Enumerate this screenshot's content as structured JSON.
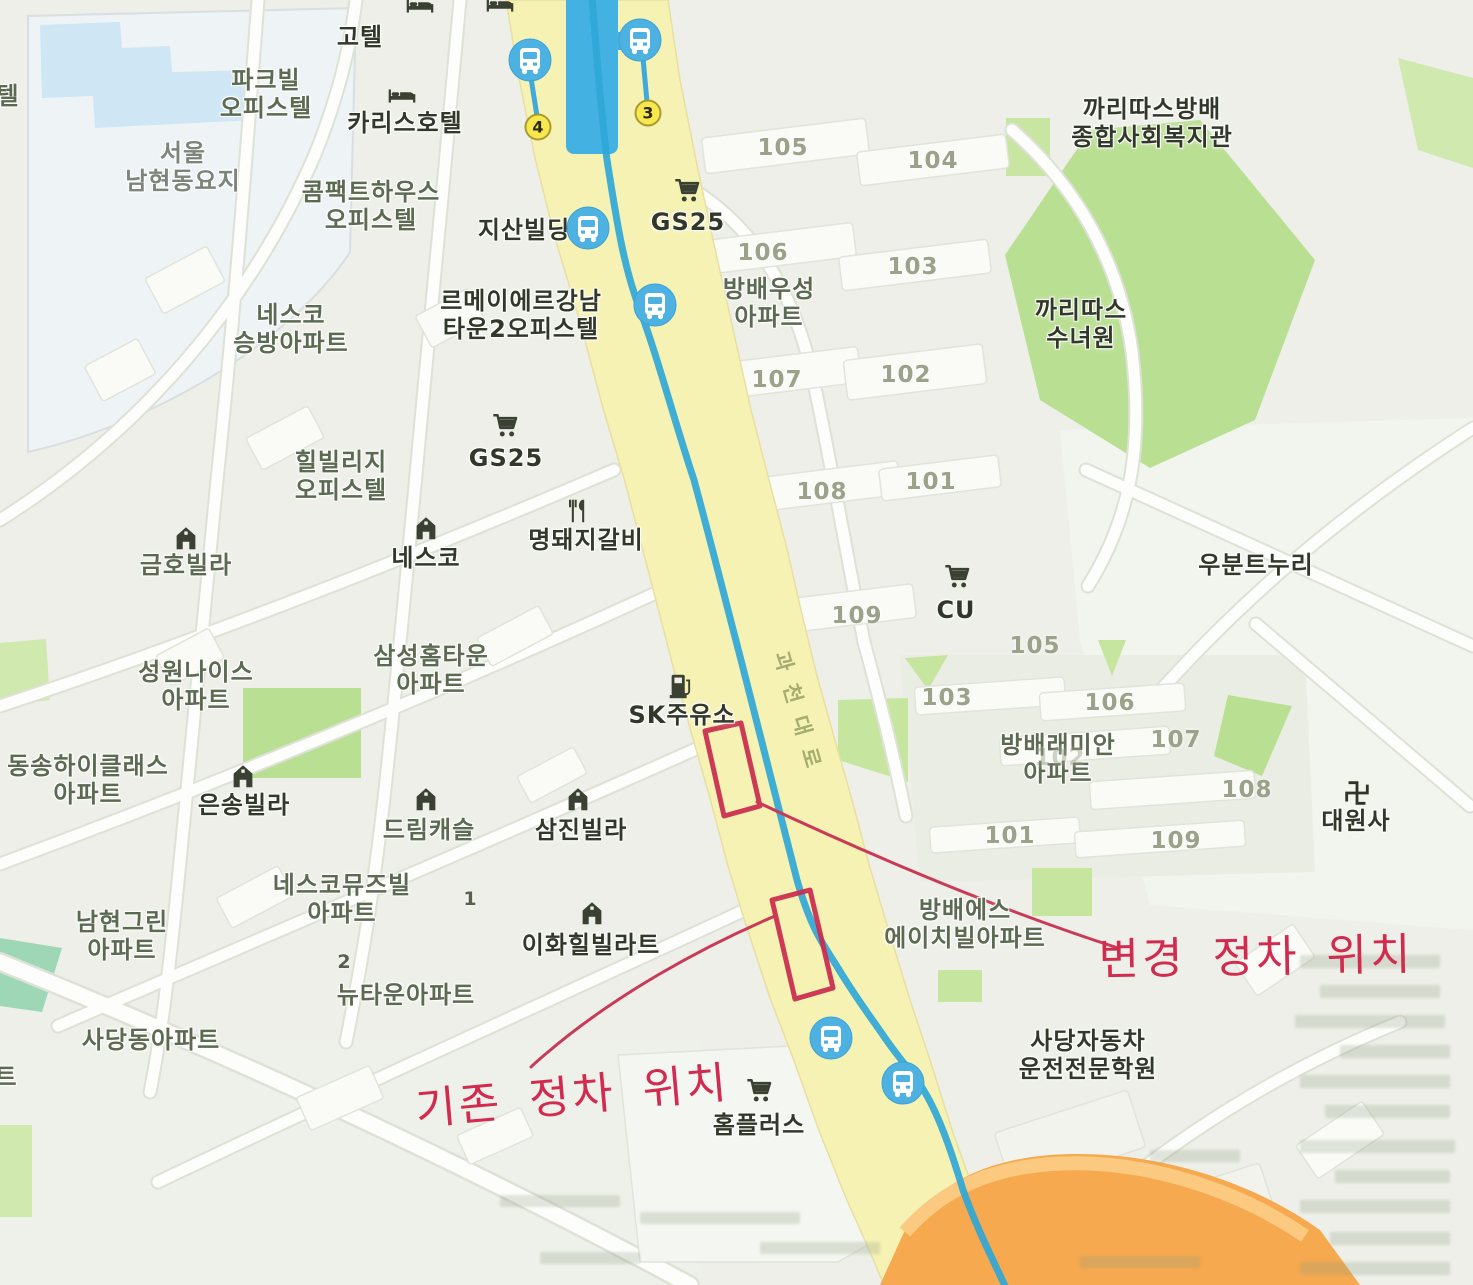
{
  "map": {
    "colors": {
      "annotation_red": "#d22b50",
      "route_blue": "#2fa7d7",
      "bridge_blue": "#43b1e2",
      "main_road_yellow": "#f6f2b4",
      "ramp_orange": "#f6a94e",
      "park_green": "#b9df92",
      "bus_icon_blue": "#4db2e2",
      "badge_yellow": "#f7e84c"
    },
    "annotations": {
      "changed_stop_label": "변경 정차 위치",
      "existing_stop_label": "기존 정차 위치"
    },
    "road_name": {
      "text": "과천대로",
      "x": 800,
      "y": 716,
      "rotation_deg": 74
    },
    "route_badges": [
      {
        "number": "4",
        "x": 538,
        "y": 127
      },
      {
        "number": "3",
        "x": 648,
        "y": 113
      }
    ],
    "bus_stops": [
      {
        "x": 530,
        "y": 60
      },
      {
        "x": 640,
        "y": 40
      },
      {
        "x": 588,
        "y": 228
      },
      {
        "x": 655,
        "y": 305
      },
      {
        "x": 831,
        "y": 1038
      },
      {
        "x": 903,
        "y": 1083
      }
    ],
    "labels": [
      {
        "text": "고텔",
        "x": 360,
        "y": 38,
        "style": "dark"
      },
      {
        "text": "파크빌\n오피스텔",
        "x": 266,
        "y": 95,
        "style": "green"
      },
      {
        "text": "카리스호텔",
        "x": 405,
        "y": 124,
        "style": "dark"
      },
      {
        "text": "서울\n남현동요지",
        "x": 183,
        "y": 168,
        "style": "gray"
      },
      {
        "text": "콤팩트하우스\n오피스텔",
        "x": 371,
        "y": 207,
        "style": "green"
      },
      {
        "text": "지산빌딩",
        "x": 524,
        "y": 231,
        "style": "dark"
      },
      {
        "text": "GS25",
        "x": 688,
        "y": 223,
        "style": "dark"
      },
      {
        "text": "까리따스방배\n종합사회복지관",
        "x": 1152,
        "y": 124,
        "style": "dark"
      },
      {
        "text": "네스코\n승방아파트",
        "x": 291,
        "y": 330,
        "style": "green"
      },
      {
        "text": "르메이에르강남\n타운2오피스텔",
        "x": 521,
        "y": 316,
        "style": "dark"
      },
      {
        "text": "방배우성\n아파트",
        "x": 769,
        "y": 304,
        "style": "green"
      },
      {
        "text": "까리따스\n수녀원",
        "x": 1081,
        "y": 325,
        "style": "dark"
      },
      {
        "text": "힐빌리지\n오피스텔",
        "x": 341,
        "y": 477,
        "style": "green"
      },
      {
        "text": "GS25",
        "x": 506,
        "y": 459,
        "style": "dark"
      },
      {
        "text": "금호빌라",
        "x": 186,
        "y": 566,
        "style": "green"
      },
      {
        "text": "네스코",
        "x": 426,
        "y": 559,
        "style": "dark"
      },
      {
        "text": "명돼지갈비",
        "x": 586,
        "y": 541,
        "style": "dark"
      },
      {
        "text": "우분트누리",
        "x": 1256,
        "y": 566,
        "style": "dark"
      },
      {
        "text": "CU",
        "x": 956,
        "y": 611,
        "style": "dark"
      },
      {
        "text": "성원나이스\n아파트",
        "x": 196,
        "y": 687,
        "style": "green"
      },
      {
        "text": "삼성홈타운\n아파트",
        "x": 431,
        "y": 671,
        "style": "green"
      },
      {
        "text": "SK주유소",
        "x": 682,
        "y": 716,
        "style": "dark"
      },
      {
        "text": "방배래미안\n아파트",
        "x": 1058,
        "y": 760,
        "style": "green"
      },
      {
        "text": "동송하이클래스\n아파트",
        "x": 88,
        "y": 781,
        "style": "green"
      },
      {
        "text": "은송빌라",
        "x": 244,
        "y": 806,
        "style": "dark"
      },
      {
        "text": "드림캐슬",
        "x": 429,
        "y": 831,
        "style": "green"
      },
      {
        "text": "삼진빌라",
        "x": 581,
        "y": 831,
        "style": "dark"
      },
      {
        "text": "대원사",
        "x": 1356,
        "y": 822,
        "style": "dark"
      },
      {
        "text": "네스코뮤즈빌\n아파트",
        "x": 342,
        "y": 900,
        "style": "green"
      },
      {
        "text": "남현그린\n아파트",
        "x": 122,
        "y": 937,
        "style": "green"
      },
      {
        "text": "이화힐빌라트",
        "x": 591,
        "y": 946,
        "style": "dark"
      },
      {
        "text": "뉴타운아파트",
        "x": 406,
        "y": 996,
        "style": "green"
      },
      {
        "text": "사당동아파트",
        "x": 151,
        "y": 1041,
        "style": "green"
      },
      {
        "text": "방배에스\n에이치빌아파트",
        "x": 965,
        "y": 925,
        "style": "green"
      },
      {
        "text": "사당자동차\n운전전문학원",
        "x": 1088,
        "y": 1056,
        "style": "dark"
      },
      {
        "text": "홈플러스",
        "x": 759,
        "y": 1126,
        "style": "dark"
      },
      {
        "text": "텔",
        "x": 8,
        "y": 97,
        "style": "green"
      },
      {
        "text": "트",
        "x": 6,
        "y": 1078,
        "style": "green"
      }
    ],
    "building_numbers": [
      {
        "text": "105",
        "x": 783,
        "y": 148
      },
      {
        "text": "104",
        "x": 933,
        "y": 161
      },
      {
        "text": "106",
        "x": 763,
        "y": 253
      },
      {
        "text": "103",
        "x": 913,
        "y": 267
      },
      {
        "text": "107",
        "x": 777,
        "y": 380
      },
      {
        "text": "102",
        "x": 906,
        "y": 375
      },
      {
        "text": "108",
        "x": 822,
        "y": 492
      },
      {
        "text": "101",
        "x": 931,
        "y": 482
      },
      {
        "text": "109",
        "x": 857,
        "y": 616
      },
      {
        "text": "105",
        "x": 1035,
        "y": 646
      },
      {
        "text": "103",
        "x": 947,
        "y": 698
      },
      {
        "text": "106",
        "x": 1110,
        "y": 703
      },
      {
        "text": "107",
        "x": 1176,
        "y": 740
      },
      {
        "text": "102",
        "x": 1060,
        "y": 758,
        "faint": true
      },
      {
        "text": "108",
        "x": 1247,
        "y": 790
      },
      {
        "text": "101",
        "x": 1010,
        "y": 836
      },
      {
        "text": "109",
        "x": 1176,
        "y": 841
      }
    ],
    "small_numbers": [
      {
        "text": "1",
        "x": 470,
        "y": 899
      },
      {
        "text": "2",
        "x": 344,
        "y": 962
      }
    ],
    "icons": [
      {
        "name": "bed-icon",
        "x": 402,
        "y": 96
      },
      {
        "name": "bed-icon",
        "x": 420,
        "y": 6
      },
      {
        "name": "bed-icon",
        "x": 500,
        "y": 5
      },
      {
        "name": "cart-icon",
        "x": 688,
        "y": 191
      },
      {
        "name": "cart-icon",
        "x": 506,
        "y": 426
      },
      {
        "name": "cart-icon",
        "x": 958,
        "y": 577
      },
      {
        "name": "cart-icon",
        "x": 760,
        "y": 1091
      },
      {
        "name": "building-icon",
        "x": 186,
        "y": 538
      },
      {
        "name": "building-icon",
        "x": 426,
        "y": 528
      },
      {
        "name": "building-icon",
        "x": 243,
        "y": 776
      },
      {
        "name": "building-icon",
        "x": 426,
        "y": 799
      },
      {
        "name": "building-icon",
        "x": 578,
        "y": 799
      },
      {
        "name": "building-icon",
        "x": 592,
        "y": 913
      },
      {
        "name": "utensils-icon",
        "x": 578,
        "y": 511
      },
      {
        "name": "fuel-icon",
        "x": 681,
        "y": 686
      },
      {
        "name": "swastika-icon",
        "x": 1357,
        "y": 793
      }
    ]
  }
}
